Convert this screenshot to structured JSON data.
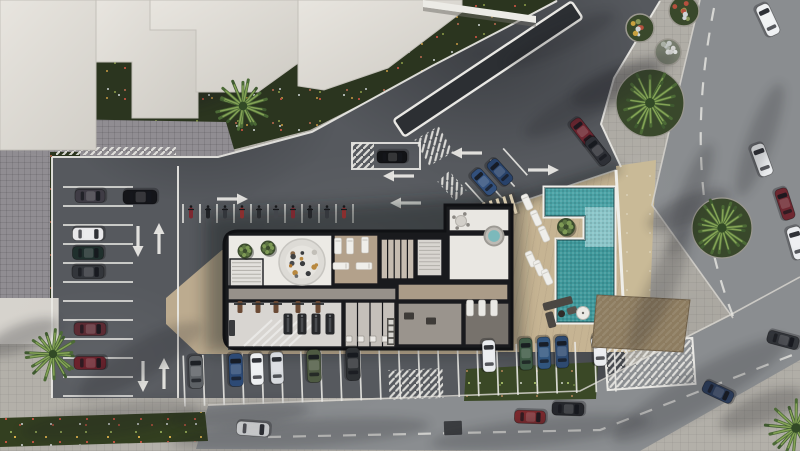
{
  "scene": {
    "description": "Aerial top-down architectural rendering of a residential amenity building with cutaway interior floor plan, L-shaped swimming pool with sun deck, surrounding parking lots, streets and palm trees"
  },
  "palette": {
    "asphalt": "#56595e",
    "street": "#8a8d90",
    "sidewalk": "#b3b0a9",
    "cobble": "#908d92",
    "deck": "#c6b493",
    "sand": "#c9ba97",
    "vegetation": "#2b351f",
    "roof": "#dad7d0",
    "wall": "#191a1d",
    "floor_white": "#eceae5",
    "floor_tan": "#b3a18b",
    "pool_deep": "#3f989b",
    "pool_shallow": "#8ac5c8",
    "marking": "#e9e8e4",
    "island": "#2c2f33"
  },
  "ground": {
    "polygons": [
      {
        "name": "vegetation-topleft",
        "cls": "veg",
        "pts": [
          [
            0,
            0
          ],
          [
            556,
            0
          ],
          [
            428,
            70
          ],
          [
            310,
            130
          ],
          [
            216,
            154
          ],
          [
            52,
            154
          ],
          [
            0,
            138
          ]
        ]
      },
      {
        "name": "cobble-band",
        "cls": "cobble",
        "pts": [
          [
            0,
            118
          ],
          [
            226,
            122
          ],
          [
            236,
            156
          ],
          [
            52,
            158
          ],
          [
            0,
            148
          ]
        ]
      },
      {
        "name": "cobble-left",
        "cls": "cobble",
        "pts": [
          [
            0,
            148
          ],
          [
            52,
            158
          ],
          [
            52,
            336
          ],
          [
            0,
            330
          ]
        ]
      },
      {
        "name": "vegetation-left-strip",
        "cls": "veg",
        "pts": [
          [
            50,
            152
          ],
          [
            80,
            152
          ],
          [
            80,
            296
          ],
          [
            50,
            300
          ]
        ]
      },
      {
        "name": "parking-lot",
        "cls": "lot",
        "pts": [
          [
            52,
            156
          ],
          [
            218,
            156
          ],
          [
            312,
            132
          ],
          [
            432,
            66
          ],
          [
            558,
            0
          ],
          [
            660,
            0
          ],
          [
            614,
            78
          ],
          [
            601,
            124
          ],
          [
            621,
            168
          ],
          [
            626,
            398
          ],
          [
            52,
            398
          ]
        ]
      },
      {
        "name": "street-right",
        "cls": "street",
        "pts": [
          [
            700,
            0
          ],
          [
            800,
            0
          ],
          [
            800,
            290
          ],
          [
            733,
            318
          ],
          [
            652,
            205
          ],
          [
            678,
            93
          ]
        ]
      },
      {
        "name": "street-bottom",
        "cls": "street",
        "pts": [
          [
            208,
            406
          ],
          [
            580,
            392
          ],
          [
            730,
            316
          ],
          [
            800,
            278
          ],
          [
            800,
            360
          ],
          [
            640,
            451
          ],
          [
            196,
            449
          ]
        ]
      },
      {
        "name": "flower-bed",
        "cls": "flowers",
        "pts": [
          [
            0,
            418
          ],
          [
            205,
            412
          ],
          [
            208,
            441
          ],
          [
            0,
            447
          ]
        ]
      },
      {
        "name": "green-strip",
        "cls": "veg2",
        "pts": [
          [
            466,
            369
          ],
          [
            598,
            362
          ],
          [
            596,
            399
          ],
          [
            464,
            401
          ]
        ]
      },
      {
        "name": "sand-strip",
        "cls": "sand",
        "pts": [
          [
            616,
            166
          ],
          [
            656,
            160
          ],
          [
            648,
            349
          ],
          [
            624,
            353
          ]
        ]
      },
      {
        "name": "pool-deck",
        "cls": "deck",
        "pts": [
          [
            484,
            214
          ],
          [
            616,
            170
          ],
          [
            626,
            352
          ],
          [
            494,
            352
          ]
        ]
      },
      {
        "name": "building-apron",
        "cls": "apron",
        "pts": [
          [
            166,
            298
          ],
          [
            222,
            250
          ],
          [
            228,
            250
          ],
          [
            228,
            350
          ],
          [
            482,
            350
          ],
          [
            482,
            354
          ],
          [
            198,
            354
          ],
          [
            166,
            324
          ]
        ]
      },
      {
        "name": "corner-building",
        "cls": "block",
        "pts": [
          [
            0,
            298
          ],
          [
            58,
            298
          ],
          [
            58,
            344
          ],
          [
            0,
            344
          ]
        ]
      }
    ]
  },
  "markings": {
    "boundaries": [
      "M52,157 L218,157 L312,132 L432,66 L557,1",
      "M52,157 L52,398",
      "M660,1 L614,78 L601,124 L621,167",
      "M178,166 L178,398"
    ],
    "curbs": [
      "M700,0 L678,93 L652,205 L733,318",
      "M208,405 L580,391 L730,315 L800,277",
      "M484,214 L616,170",
      "M58,298 L58,344"
    ],
    "dashes": [
      "M714,8 Q680,180 733,316",
      "M268,437 L600,430 L800,352"
    ],
    "stall_groups": [
      {
        "name": "left-column",
        "type": "h",
        "x1": 63,
        "x2": 133,
        "y0": 187,
        "step": 19,
        "count": 12
      },
      {
        "name": "bike-row",
        "type": "v",
        "y1": 204,
        "y2": 223,
        "x0": 183,
        "step": 17,
        "count": 11
      },
      {
        "name": "bottom-row",
        "type": "v",
        "y1": 348,
        "y2": 399,
        "x0": 184,
        "step": 19.6,
        "count": 23,
        "rot": -2,
        "cx": 400,
        "cy": 374
      },
      {
        "name": "diagonal-stalls",
        "type": "v",
        "y1": 160,
        "y2": 196,
        "x0": 472,
        "step": 17,
        "count": 4,
        "rot": -42,
        "cx": 498,
        "cy": 180
      }
    ],
    "island": {
      "cx": 488,
      "cy": 69,
      "len": 214,
      "w": 20,
      "rot": -33.7
    },
    "parking_box": {
      "x": 352,
      "y": 143,
      "w": 68,
      "h": 26
    },
    "hatches": [
      {
        "cx": 363,
        "cy": 156,
        "w": 22,
        "h": 26,
        "rot": 0
      },
      {
        "cx": 434,
        "cy": 146,
        "w": 28,
        "h": 30,
        "rot": -30
      },
      {
        "cx": 416,
        "cy": 384,
        "w": 54,
        "h": 30,
        "rot": -2
      },
      {
        "cx": 650,
        "cy": 364,
        "w": 88,
        "h": 46,
        "rot": -4,
        "border": true
      },
      {
        "cx": 452,
        "cy": 186,
        "w": 16,
        "h": 26,
        "rot": -42
      },
      {
        "cx": 116,
        "cy": 151,
        "w": 120,
        "h": 8,
        "rot": 0
      }
    ],
    "arrows": [
      {
        "x": 138,
        "y": 240,
        "dir": "down"
      },
      {
        "x": 159,
        "y": 240,
        "dir": "up"
      },
      {
        "x": 143,
        "y": 375,
        "dir": "down"
      },
      {
        "x": 164,
        "y": 375,
        "dir": "up"
      },
      {
        "x": 231,
        "y": 199,
        "dir": "right"
      },
      {
        "x": 400,
        "y": 176,
        "dir": "left"
      },
      {
        "x": 407,
        "y": 203,
        "dir": "left"
      },
      {
        "x": 468,
        "y": 153,
        "dir": "left"
      },
      {
        "x": 542,
        "y": 170,
        "dir": "right"
      }
    ]
  },
  "shadows": {
    "casts": [
      {
        "points": "206,214 520,194 522,352 206,352",
        "opacity": 0.42,
        "blur": "b8"
      },
      {
        "points": "478,206 618,162 621,172 484,218",
        "opacity": 0.3,
        "blur": "b5"
      }
    ],
    "streaks": [
      [
        600,
        95,
        85,
        16,
        -28
      ],
      [
        560,
        40,
        60,
        12,
        -25
      ],
      [
        660,
        290,
        70,
        14,
        -65
      ],
      [
        700,
        390,
        100,
        20,
        -30
      ],
      [
        540,
        432,
        110,
        14,
        -6
      ],
      [
        300,
        434,
        130,
        14,
        -4
      ],
      [
        110,
        420,
        90,
        16,
        -8
      ],
      [
        140,
        360,
        70,
        18,
        -30
      ],
      [
        760,
        140,
        60,
        13,
        -70
      ],
      [
        240,
        415,
        70,
        12,
        -5
      ],
      [
        690,
        200,
        60,
        12,
        -70
      ]
    ]
  },
  "roofs": {
    "polys": [
      {
        "name": "building-roof-a",
        "pts": "0,0 138,0 138,62 96,62 96,150 0,150"
      },
      {
        "name": "building-roof-b",
        "pts": "96,0 198,0 198,118 132,118 132,62 96,62"
      },
      {
        "name": "building-roof-c",
        "pts": "150,0 308,0 308,56 258,92 196,92 196,30 150,30"
      },
      {
        "name": "building-roof-d",
        "pts": "298,0 462,0 462,12 388,68 324,90 298,86"
      }
    ],
    "white_wall": {
      "top": "423,0 536,16 536,23 423,7",
      "shade": "423,7 536,23 536,27 423,11"
    }
  },
  "building": {
    "outline": "M238,231 L445,231 L445,205 L512,205 L512,349 L238,349 Q224,349 224,335 L224,245 Q224,231 238,231 Z",
    "rooms": [
      {
        "name": "lobby",
        "x": 228,
        "y": 235,
        "w": 104,
        "h": 51,
        "f": "#eceae5"
      },
      {
        "name": "stair-room",
        "x": 230,
        "y": 259,
        "w": 33,
        "h": 27,
        "f": "#e2e0dc",
        "opt": "steps"
      },
      {
        "name": "spa-room",
        "x": 334,
        "y": 235,
        "w": 44,
        "h": 49,
        "f": "#b3a18b"
      },
      {
        "name": "changing-cubicles",
        "x": 381,
        "y": 239,
        "w": 33,
        "h": 40,
        "f": "#c6bcb0",
        "opt": "div-5"
      },
      {
        "name": "stairwell",
        "x": 417,
        "y": 239,
        "w": 25,
        "h": 37,
        "f": "#d8d5d0",
        "opt": "steps"
      },
      {
        "name": "suite-top",
        "x": 449,
        "y": 209,
        "w": 60,
        "h": 22,
        "f": "#e9e7e2"
      },
      {
        "name": "suite",
        "x": 449,
        "y": 235,
        "w": 60,
        "h": 45,
        "f": "#e9e7e2"
      },
      {
        "name": "corridor",
        "x": 228,
        "y": 288,
        "w": 168,
        "h": 12,
        "f": "#97918a"
      },
      {
        "name": "corridor-2",
        "x": 398,
        "y": 284,
        "w": 110,
        "h": 16,
        "f": "#ab9c88"
      },
      {
        "name": "gym",
        "x": 228,
        "y": 302,
        "w": 114,
        "h": 45,
        "f": "#d8d5d1"
      },
      {
        "name": "lockers",
        "x": 345,
        "y": 302,
        "w": 50,
        "h": 45,
        "f": "#c5c0ba",
        "opt": "div-4"
      },
      {
        "name": "relax-room",
        "x": 398,
        "y": 303,
        "w": 64,
        "h": 42,
        "f": "#9a948d"
      },
      {
        "name": "lounge-room",
        "x": 465,
        "y": 303,
        "w": 44,
        "h": 42,
        "f": "#77726c"
      }
    ],
    "circle_lounge": {
      "cx": 302,
      "cy": 262,
      "r": 23
    },
    "plants": [
      [
        245,
        251
      ],
      [
        268,
        248
      ]
    ],
    "spa_beds": [
      [
        338,
        246,
        0
      ],
      [
        350,
        246,
        0
      ],
      [
        365,
        245,
        0
      ],
      [
        341,
        266,
        90
      ],
      [
        364,
        266,
        90
      ]
    ],
    "treadmills": [
      [
        288,
        324
      ],
      [
        302,
        324
      ],
      [
        316,
        324
      ],
      [
        330,
        324
      ]
    ],
    "benches": [
      [
        240,
        307
      ],
      [
        258,
        307
      ],
      [
        276,
        307
      ],
      [
        298,
        307
      ],
      [
        318,
        307
      ]
    ],
    "rack": [
      232,
      328
    ],
    "fixtures": [
      [
        349,
        339
      ],
      [
        361,
        339
      ],
      [
        373,
        339
      ],
      [
        385,
        339
      ]
    ],
    "shelf": [
      387,
      318,
      8,
      27
    ],
    "indoor_loungers": [
      [
        470,
        308
      ],
      [
        482,
        308
      ],
      [
        494,
        308
      ]
    ],
    "jacuzzi": [
      494,
      236,
      9.5
    ],
    "round_table": [
      461,
      221,
      5.5
    ],
    "relax_items": [
      [
        409,
        316
      ],
      [
        431,
        321
      ]
    ]
  },
  "pool": {
    "outline": "M545,188 H614 V322 H557 V240 H585 V216 H545 Z",
    "top_band": {
      "x": 545,
      "y": 188,
      "w": 69,
      "h": 28,
      "c": "#4aa2a5"
    },
    "shallow": {
      "x": 585,
      "y": 207,
      "w": 29,
      "h": 40,
      "c": "#8ac5c8"
    },
    "deep": {
      "x": 557,
      "y": 240,
      "w": 57,
      "h": 82,
      "c": "#3f989b"
    },
    "plant": {
      "x": 566,
      "y": 227,
      "r": 9
    },
    "wall": "M616,170 L626,352",
    "loungers": [
      [
        527,
        202
      ],
      [
        536,
        218
      ],
      [
        544,
        234
      ],
      [
        531,
        259
      ],
      [
        539,
        268
      ],
      [
        547,
        277
      ]
    ],
    "sofa": {
      "x": 560,
      "y": 308,
      "rot": -15
    },
    "umbrella": {
      "x": 583,
      "y": 313,
      "r": 6.5
    },
    "pergola": {
      "x": 497,
      "y": 209,
      "rot": -17
    },
    "awning": {
      "pts": "597,295 690,300 683,352 592,347",
      "c": "#8d7c60"
    }
  },
  "vehicles": {
    "cars": [
      [
        90,
        196,
        90,
        30,
        13,
        "#3f3c45"
      ],
      [
        140,
        197,
        90,
        34,
        14,
        "#141519"
      ],
      [
        88,
        234,
        90,
        31,
        13,
        "#e8e8ea"
      ],
      [
        88,
        253,
        90,
        31,
        13,
        "#20302d"
      ],
      [
        88,
        272,
        90,
        32,
        13,
        "#33363b"
      ],
      [
        90,
        329,
        90,
        32,
        13,
        "#5c2b33"
      ],
      [
        90,
        363,
        90,
        32,
        13,
        "#6b222c"
      ],
      [
        196,
        372,
        -2,
        33,
        14,
        "#5d6165"
      ],
      [
        236,
        370,
        -2,
        33,
        14,
        "#2d4a75"
      ],
      [
        257,
        369,
        -2,
        32,
        13,
        "#edeff1"
      ],
      [
        277,
        368,
        -2,
        32,
        13,
        "#d7dade"
      ],
      [
        314,
        366,
        -2,
        33,
        14,
        "#4e5a42"
      ],
      [
        353,
        364,
        -2,
        33,
        14,
        "#2e3134"
      ],
      [
        489,
        356,
        -2,
        32,
        13,
        "#e9ebee"
      ],
      [
        526,
        354,
        -2,
        32,
        13,
        "#3e5a45"
      ],
      [
        544,
        353,
        -2,
        32,
        13,
        "#31557e"
      ],
      [
        562,
        352,
        -2,
        32,
        13,
        "#2e4a70"
      ],
      [
        600,
        350,
        -2,
        32,
        13,
        "#eaecef"
      ],
      [
        392,
        157,
        90,
        30,
        12,
        "#121316"
      ],
      [
        253,
        429,
        94,
        33,
        14,
        "#f0f2f3"
      ],
      [
        530,
        417,
        92,
        31,
        13,
        "#7c2a2e"
      ],
      [
        568,
        409,
        92,
        32,
        13,
        "#25272c"
      ],
      [
        583,
        132,
        -38,
        30,
        13,
        "#6e2630"
      ],
      [
        598,
        151,
        -38,
        31,
        13,
        "#2e3036"
      ],
      [
        484,
        182,
        -42,
        29,
        13,
        "#32507c"
      ],
      [
        500,
        172,
        -42,
        29,
        13,
        "#28426a"
      ],
      [
        768,
        20,
        -25,
        33,
        14,
        "#eff1f3"
      ],
      [
        762,
        160,
        -20,
        33,
        14,
        "#edeff1"
      ],
      [
        785,
        204,
        -18,
        32,
        13,
        "#6e2831"
      ],
      [
        797,
        243,
        -16,
        33,
        14,
        "#ebedf0"
      ],
      [
        718,
        392,
        115,
        32,
        13,
        "#2c3e5e"
      ],
      [
        783,
        340,
        105,
        32,
        13,
        "#33363b"
      ],
      [
        604,
        341,
        80,
        26,
        11,
        "#e6e8e9"
      ]
    ],
    "motorbike_row": {
      "y": 213,
      "x0": 191,
      "step": 17,
      "colors": [
        "#7c2830",
        "#202226",
        "#33363b",
        "#8a2f2f",
        "#2a2c30",
        "#43464b",
        "#7c2830",
        "#24262a",
        "#35383d",
        "#8a2f2f"
      ]
    },
    "street_grate": {
      "x": 444,
      "y": 421,
      "w": 18,
      "h": 14
    }
  },
  "landscape": {
    "palms": [
      {
        "x": 243,
        "y": 106,
        "r": 27
      },
      {
        "x": 650,
        "y": 103,
        "r": 31,
        "bed": 34
      },
      {
        "x": 722,
        "y": 228,
        "r": 29,
        "bed": 30
      },
      {
        "x": 53,
        "y": 354,
        "r": 26
      },
      {
        "x": 796,
        "y": 428,
        "r": 30
      }
    ],
    "planters": [
      {
        "cx": 640,
        "cy": 28,
        "r": 14,
        "kind": "green"
      },
      {
        "cx": 684,
        "cy": 11,
        "r": 15,
        "kind": "green"
      },
      {
        "cx": 668,
        "cy": 52,
        "r": 13,
        "kind": "gray"
      }
    ]
  }
}
